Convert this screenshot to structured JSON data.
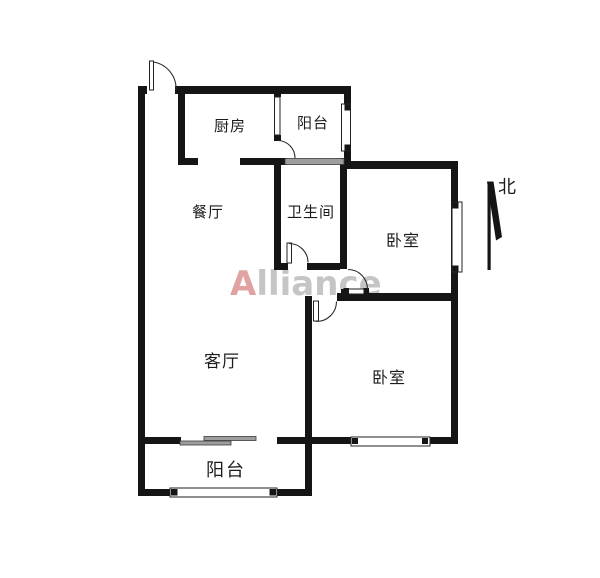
{
  "floorplan": {
    "watermark": {
      "first_letter": "A",
      "rest": "lliance"
    },
    "compass": {
      "label": "北"
    },
    "rooms": {
      "kitchen": {
        "label": "厨房"
      },
      "balcony_north": {
        "label": "阳台"
      },
      "bathroom": {
        "label": "卫生间"
      },
      "dining": {
        "label": "餐厅"
      },
      "bedroom_north": {
        "label": "卧室"
      },
      "living": {
        "label": "客厅"
      },
      "bedroom_south": {
        "label": "卧室"
      },
      "balcony_south": {
        "label": "阳台"
      }
    },
    "colors": {
      "wall": "#151515",
      "background": "#ffffff",
      "grey_window": "#9e9e9e",
      "watermark_a": "#cd6464",
      "watermark_rest": "#969696"
    }
  }
}
